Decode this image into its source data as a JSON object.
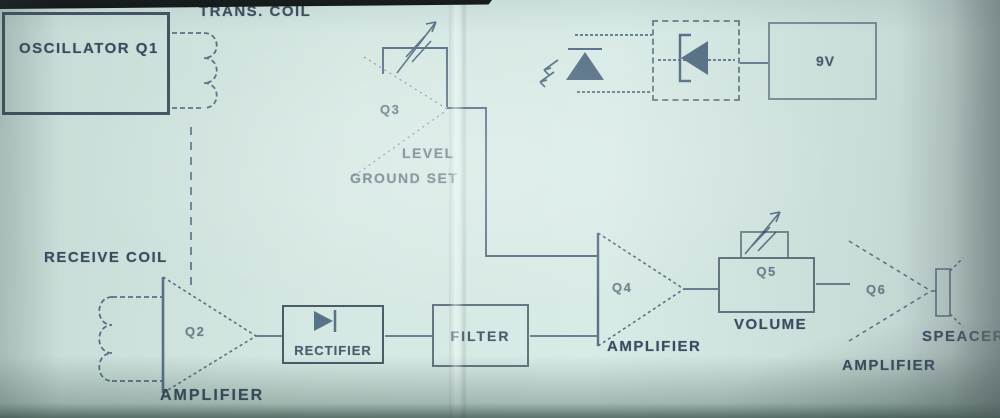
{
  "colors": {
    "paper": "#cfe2dd",
    "ink": "#2b4055",
    "line": "#3a5570",
    "scan_band": "#0d100f"
  },
  "transmit_section": {
    "oscillator_label": "OSCILLATOR Q1",
    "trans_coil_label": "TRANS. COIL",
    "q3_label": "Q3",
    "level_label": "LEVEL",
    "ground_set_label": "GROUND SET"
  },
  "power_section": {
    "battery_label": "9V"
  },
  "receive_section": {
    "receive_coil_label": "RECEIVE COIL",
    "q2_label": "Q2",
    "q2_amplifier_label": "AMPLIFIER",
    "rectifier_label": "RECTIFIER",
    "filter_label": "FILTER",
    "q4_label": "Q4",
    "q4_amplifier_label": "AMPLIFIER",
    "q5_label": "Q5",
    "volume_label": "VOLUME",
    "q6_label": "Q6",
    "q6_amplifier_label": "AMPLIFIER",
    "speaker_label": "SPEACER"
  }
}
